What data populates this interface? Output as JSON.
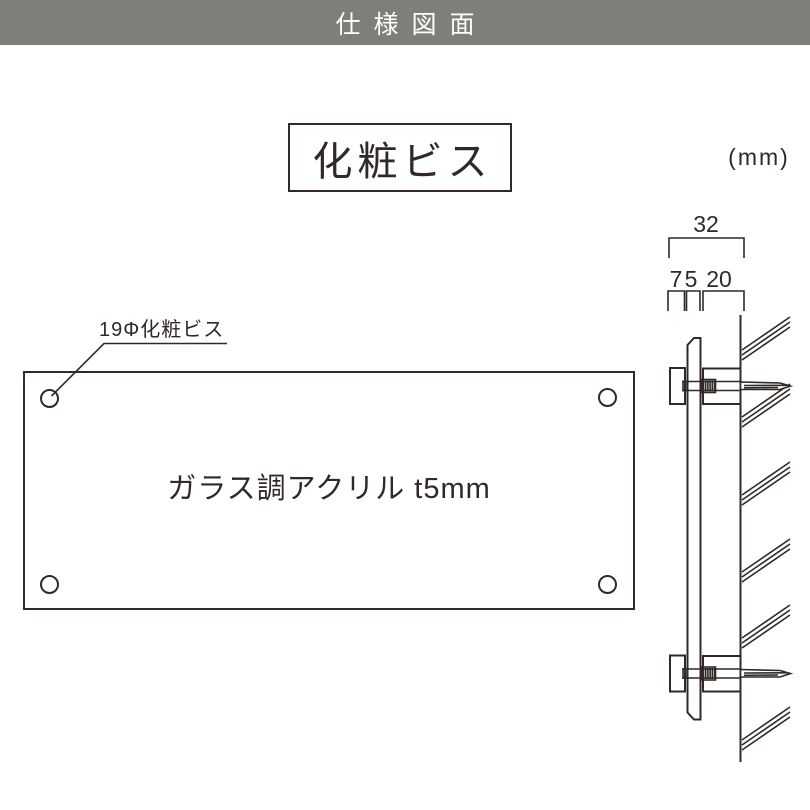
{
  "header": {
    "title": "仕様図面"
  },
  "title_box": {
    "label": "化粧ビス"
  },
  "unit_label": "(mm)",
  "front_view": {
    "material_label": "ガラス調アクリル t5mm",
    "screw_callout": "19Φ化粧ビス"
  },
  "side_view": {
    "dim_total": "32",
    "dim_cap": "7",
    "dim_panel_thickness": "5",
    "dim_standoff": "20"
  },
  "colors": {
    "header_bg": "#7d8078",
    "header_text": "#ffffff",
    "line": "#302925",
    "canvas_bg": "#ffffff"
  }
}
